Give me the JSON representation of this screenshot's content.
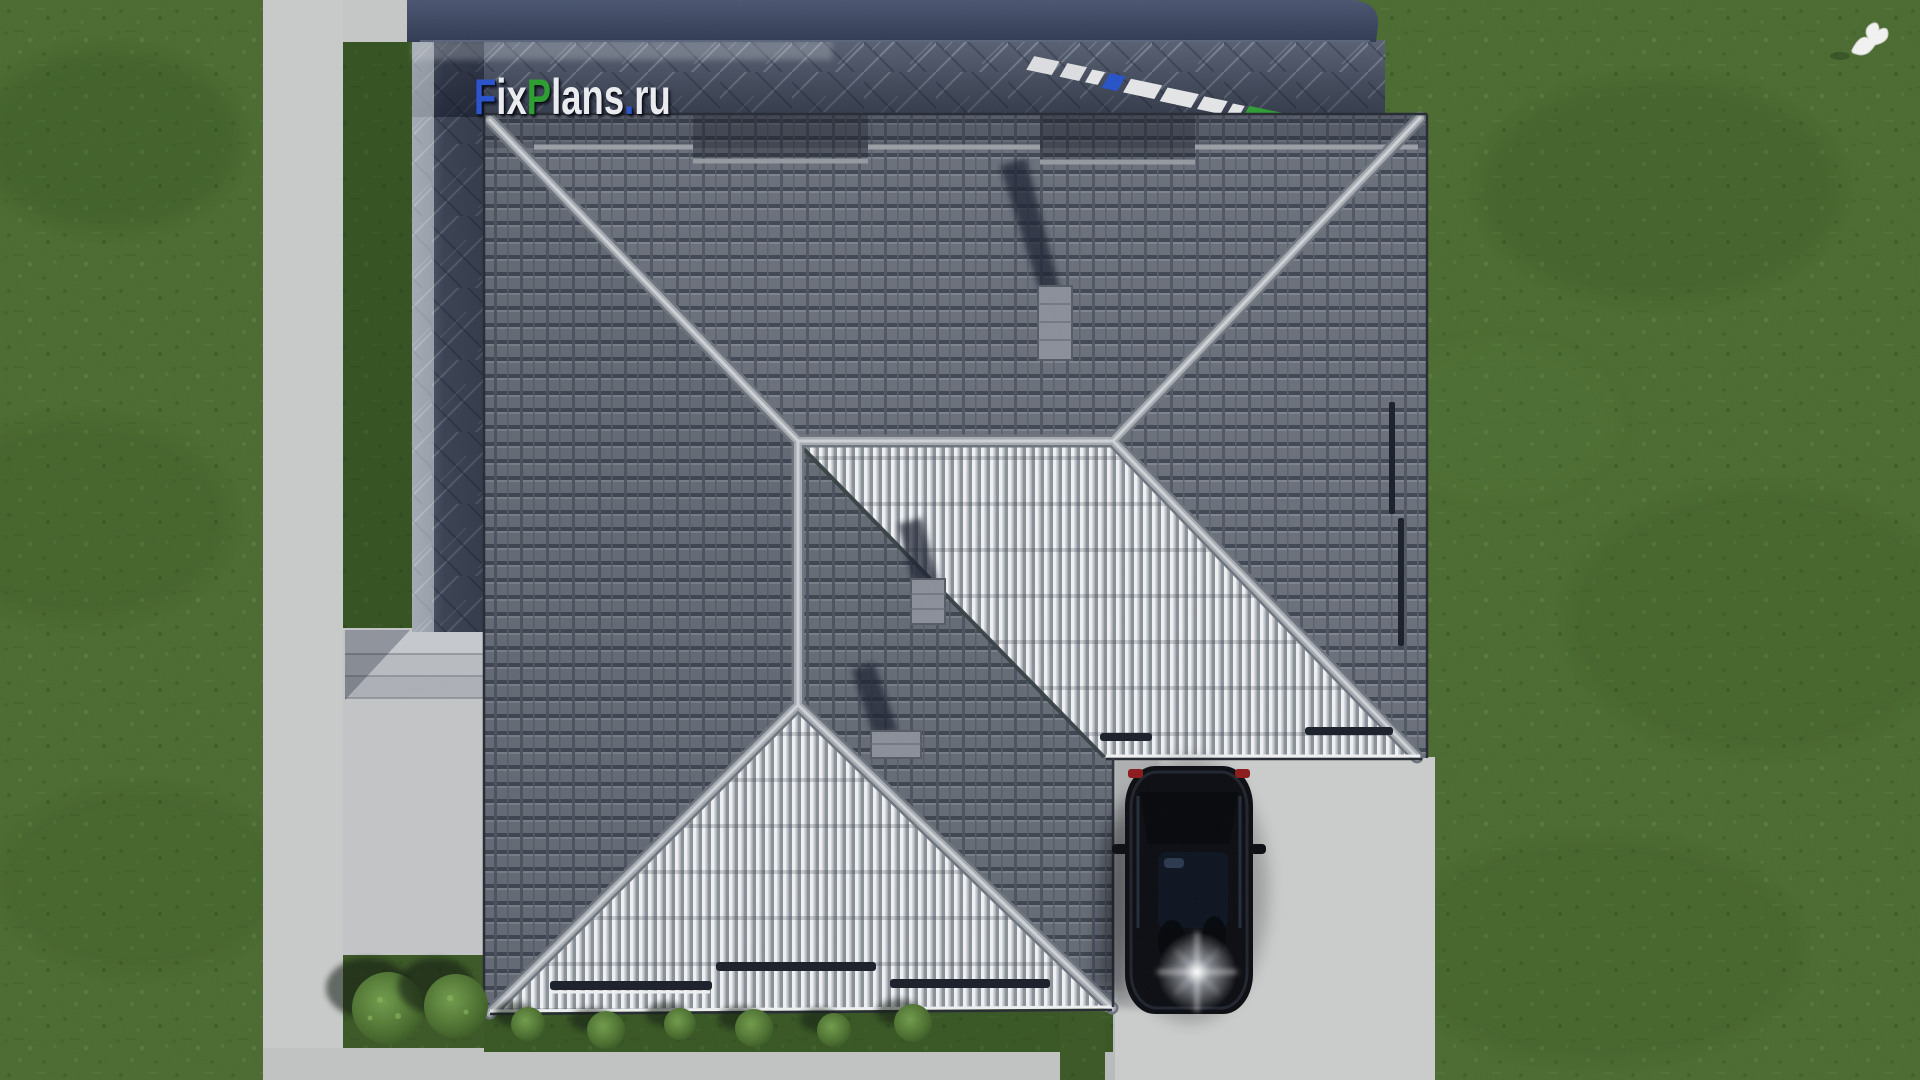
{
  "scene": {
    "description": "Aerial top-down 3D architectural render of a hip-roofed house with dark concrete roof tiles and bright ribbed metal slopes, a dark stone terrace and pool band at top, lawns, concrete walkways, a driveway with a parked black car, shrubs and a white bird flying over the grass.",
    "watermark": {
      "text": "FixPlans.ru",
      "segments": [
        {
          "text": "F",
          "color": "#2d55cb"
        },
        {
          "text": "ix",
          "color": "#e9ebee"
        },
        {
          "text": "P",
          "color": "#2f9e33"
        },
        {
          "text": "lans",
          "color": "#e9ebee"
        },
        {
          "text": ".",
          "color": "#2d55cb"
        },
        {
          "text": "ru",
          "color": "#e9ebee"
        }
      ]
    },
    "objects": {
      "roof": "hip roof: dark tiled slopes + light ribbed metal slopes with gray ridge caps",
      "chimneys": 3,
      "car": "black sedan parked on driveway, viewed from above, headlight glare at front",
      "bird": "white bird flying over lawn, top right",
      "large_bushes": 2,
      "small_bushes": 6,
      "snow_guard_bars": 7
    },
    "palette": {
      "grass": "#4b6b31",
      "grass_dark_strip": "#3a5826",
      "concrete": "#cacccb",
      "dark_tiles": "#6a707b",
      "ribbed_metal": "#e9ebee",
      "ridge_cap": "#a6abb1",
      "terrace_slate": "#5c6577",
      "pool_band": "#3b455e",
      "car_body": "#0b0d12",
      "taillight_red": "#8c1a1c"
    }
  }
}
